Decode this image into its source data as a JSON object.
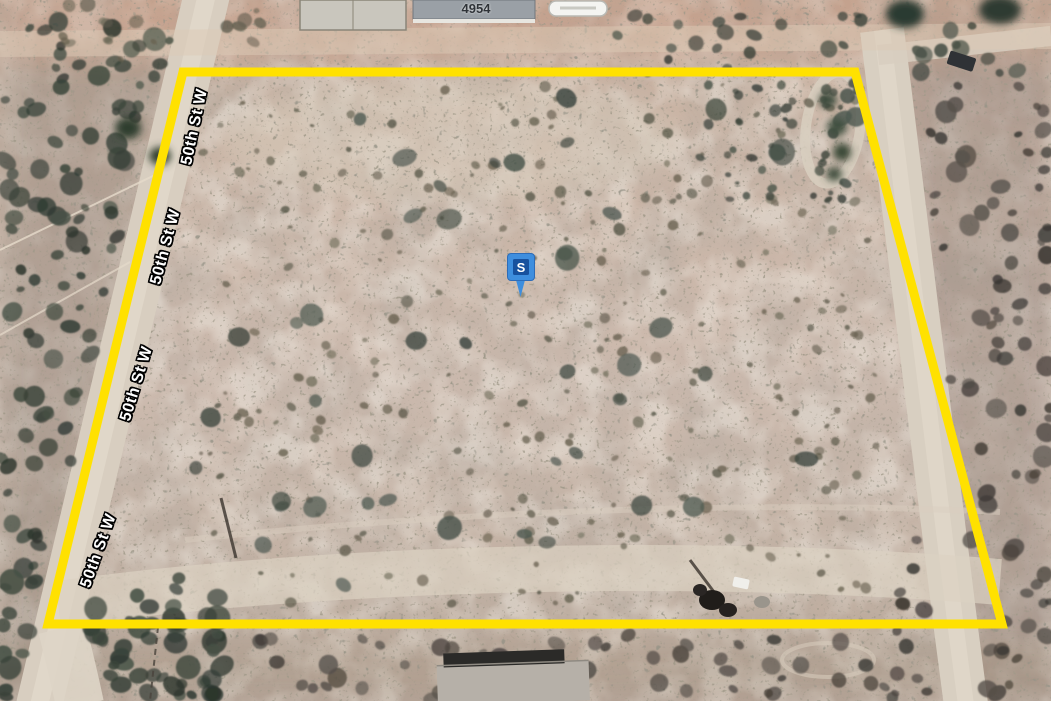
{
  "map": {
    "view_type": "satellite aerial parcel view",
    "address_label": "4954",
    "street_name": "50th St W",
    "street_labels": [
      {
        "text": "50th St W"
      },
      {
        "text": "50th St W"
      },
      {
        "text": "50th St W"
      },
      {
        "text": "50th St W"
      }
    ],
    "marker": {
      "label": "S",
      "pin_color": "#3e8ede",
      "pin_border": "#2d6cb8",
      "inner_color": "#17519e",
      "label_color": "#ffffff"
    },
    "parcel_outline": {
      "color": "#ffe100",
      "stroke_width": "9",
      "points": "183,72 855,72 1002,624 48,624"
    }
  }
}
